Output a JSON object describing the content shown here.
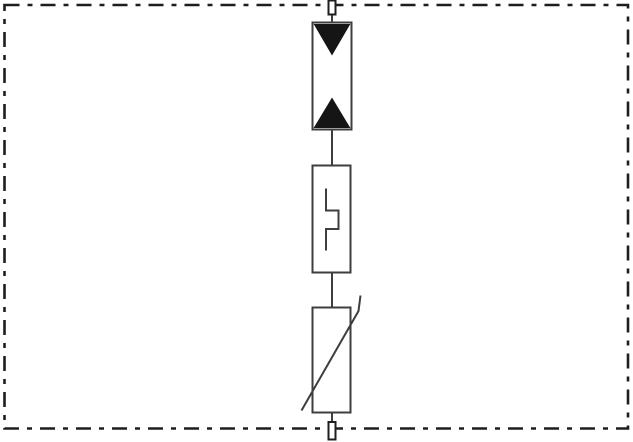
{
  "diagram": {
    "label": "Surge protective device circuit schematic",
    "type": "circuit-schematic",
    "enclosure": {
      "style": "dash-dot",
      "meaning": "device-boundary"
    },
    "colors": {
      "background": "#ffffff",
      "border_ink": "#1e1e1e",
      "line_ink": "#3e3e3e",
      "symbol_fill": "#151515",
      "component_fill": "#ffffff"
    },
    "terminals": [
      {
        "id": "top-terminal",
        "position": "top-border"
      },
      {
        "id": "bottom-terminal",
        "position": "bottom-border"
      }
    ],
    "components": [
      {
        "id": "bidirectional-suppressor-diode",
        "symbol": "rectangle with two solid triangles pointing toward each other",
        "order": 1
      },
      {
        "id": "switching-spark-gap",
        "symbol": "rectangle with stepped line glyph",
        "order": 2
      },
      {
        "id": "varistor",
        "symbol": "rectangle crossed by diagonal stroke with vertical hook",
        "order": 3
      }
    ],
    "topology": "series connection from top terminal to bottom terminal"
  }
}
